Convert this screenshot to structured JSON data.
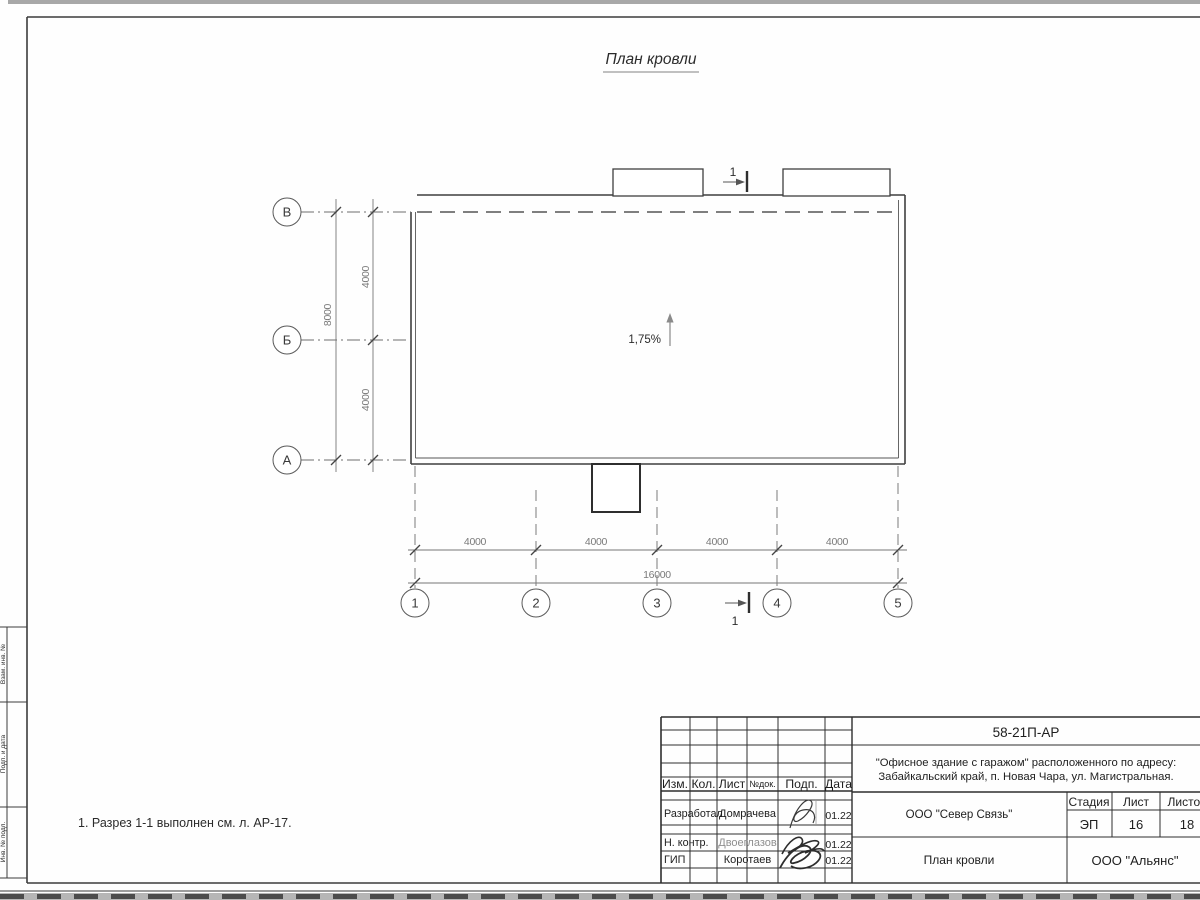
{
  "sheet": {
    "title": "План кровли",
    "note": "1. Разрез 1-1 выполнен см. л. АР-17."
  },
  "plan": {
    "slope": "1,75%",
    "section_label_top": "1",
    "section_label_bottom": "1",
    "axes_rows": [
      "В",
      "Б",
      "А"
    ],
    "axes_cols": [
      "1",
      "2",
      "3",
      "4",
      "5"
    ],
    "dim_v": [
      "4000",
      "4000"
    ],
    "dim_v_total": "8000",
    "dim_h": [
      "4000",
      "4000",
      "4000",
      "4000"
    ],
    "dim_h_total": "16000"
  },
  "stamp": {
    "doc_number": "58-21П-АР",
    "object_line1": "\"Офисное здание с гаражом\" расположенного по адресу:",
    "object_line2": "Забайкальский край, п. Новая Чара, ул. Магистральная.",
    "col_izm": "Изм.",
    "col_kol": "Кол.",
    "col_list": "Лист",
    "col_doc": "№док.",
    "col_podp": "Подп.",
    "col_data": "Дата",
    "row1_role": "Разработал",
    "row1_name": "Домрачева",
    "row1_date": "01.22",
    "row2_role": "Н. контр.",
    "row2_name": "Двоеглазов",
    "row2_date": "01.22",
    "row3_role": "ГИП",
    "row3_name": "Коротаев",
    "row3_date": "01.22",
    "contractor": "ООО \"Север Связь\"",
    "sheet_title": "План кровли",
    "company": "ООО \"Альянс\"",
    "stage_label": "Стадия",
    "stage": "ЭП",
    "list_label": "Лист",
    "list": "16",
    "listov_label": "Листов",
    "listov": "18"
  },
  "margin": {
    "label1": "Взам. инв. №",
    "label2": "Подп. и дата",
    "label3": "Инв. № подл."
  }
}
